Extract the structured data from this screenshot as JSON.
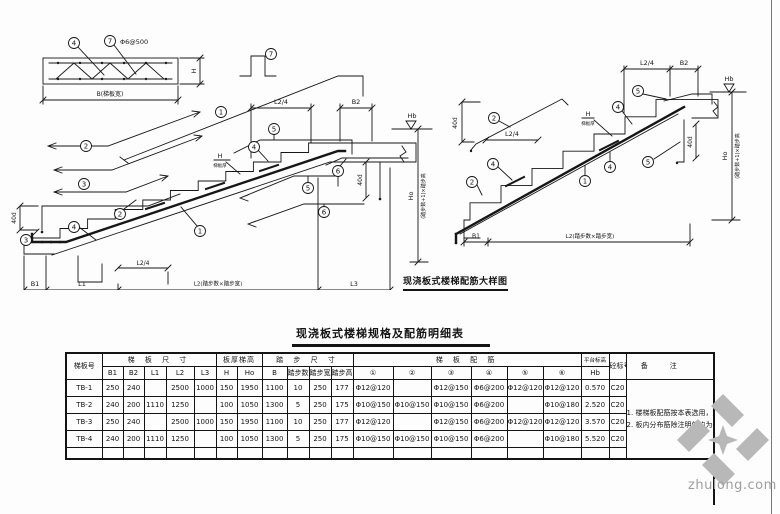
{
  "titles": {
    "left_detail": "现浇板式楼梯配筋大样图",
    "table": "现浇板式楼梯规格及配筋明细表"
  },
  "watermark": {
    "site": "zhulong.com"
  },
  "dims": {
    "b1": "B1",
    "b2": "B2",
    "l1": "L1",
    "l3": "L3",
    "l2_full": "L2(踏步数×踏步宽)",
    "l2_quarter": "L2/4",
    "h": "H",
    "ho": "Ho",
    "hb": "Hb",
    "d40": "40d",
    "ho_note": "(踏步数+1)×踏步高",
    "slab_thickness_note": "梯板厚",
    "beam_width": "B(梯板宽)",
    "bar7_spec": "Φ6@500"
  },
  "callouts": {
    "c1": "1",
    "c2": "2",
    "c3": "3",
    "c4": "4",
    "c5": "5",
    "c6": "6",
    "c7": "7"
  },
  "table": {
    "headers": {
      "id": "梯板号",
      "group_slab_dims": "梯 板 尺 寸",
      "group_thickness": "板厚梯高",
      "group_steps": "踏 步 尺 寸",
      "group_rebar": "梯 板 配 筋",
      "group_platform": "平台标高",
      "concrete": "砼标号",
      "notes": "备注",
      "sub": [
        "B1",
        "B2",
        "L1",
        "L2",
        "L3",
        "H",
        "Ho",
        "B",
        "踏步数",
        "踏步宽",
        "踏步高",
        "①",
        "②",
        "③",
        "④",
        "⑤",
        "⑥",
        "Hb"
      ]
    },
    "rows": [
      {
        "id": "TB-1",
        "values": [
          "250",
          "240",
          "",
          "2500",
          "1000",
          "150",
          "1950",
          "1100",
          "10",
          "250",
          "177",
          "Φ12@120",
          "",
          "Φ12@150",
          "Φ6@200",
          "Φ12@120",
          "Φ12@120",
          "0.570",
          "C20"
        ]
      },
      {
        "id": "TB-2",
        "values": [
          "240",
          "200",
          "1110",
          "1250",
          "",
          "100",
          "1050",
          "1300",
          "5",
          "250",
          "175",
          "Φ10@150",
          "Φ10@150",
          "Φ10@150",
          "Φ6@200",
          "",
          "Φ10@180",
          "2.520",
          "C20"
        ]
      },
      {
        "id": "TB-3",
        "values": [
          "250",
          "240",
          "",
          "2500",
          "1000",
          "150",
          "1950",
          "1100",
          "10",
          "250",
          "177",
          "Φ12@120",
          "",
          "Φ12@150",
          "Φ6@200",
          "Φ12@120",
          "Φ12@120",
          "3.570",
          "C20"
        ]
      },
      {
        "id": "TB-4",
        "values": [
          "240",
          "200",
          "1110",
          "1250",
          "",
          "100",
          "1050",
          "1300",
          "5",
          "250",
          "175",
          "Φ10@150",
          "Φ10@150",
          "Φ10@150",
          "Φ6@200",
          "",
          "Φ10@180",
          "5.520",
          "C20"
        ]
      }
    ],
    "notes": {
      "n1": "1. 楼梯板配筋按本表选用，施工前须按(1:1)放大样复核后方可施工。",
      "n2": "2. 板内分布筋除注明外均为Φ5(或Φ6)@200(或@200)，双向12%，与受力筋绑扎牢固，保护层厚度按规范取用。"
    }
  }
}
